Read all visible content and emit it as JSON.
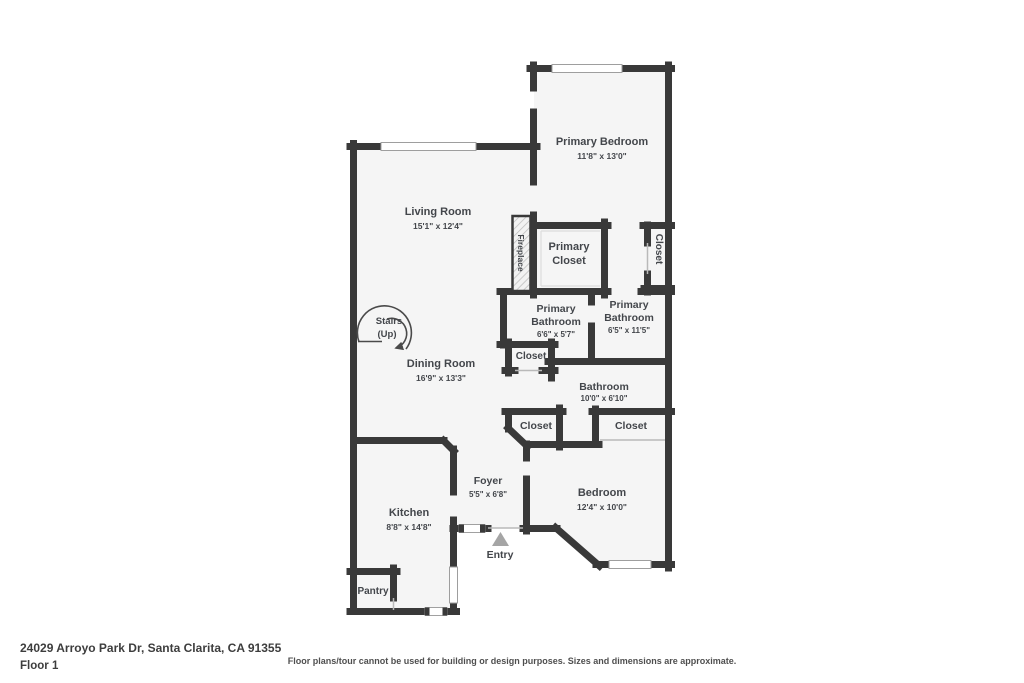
{
  "plan": {
    "rooms": {
      "living_room": {
        "name": "Living Room",
        "dims": "15'1\" x 12'4\""
      },
      "dining_room": {
        "name": "Dining Room",
        "dims": "16'9\" x 13'3\""
      },
      "kitchen": {
        "name": "Kitchen",
        "dims": "8'8\" x 14'8\""
      },
      "foyer": {
        "name": "Foyer",
        "dims": "5'5\" x 6'8\""
      },
      "primary_bedroom": {
        "name": "Primary Bedroom",
        "dims": "11'8\" x 13'0\""
      },
      "primary_closet": {
        "line1": "Primary",
        "line2": "Closet"
      },
      "primary_bathroom_small": {
        "line1": "Primary",
        "line2": "Bathroom",
        "dims": "6'6\" x 5'7\""
      },
      "primary_bathroom_large": {
        "line1": "Primary",
        "line2": "Bathroom",
        "dims": "6'5\" x 11'5\""
      },
      "bathroom": {
        "name": "Bathroom",
        "dims": "10'0\" x 6'10\""
      },
      "bedroom": {
        "name": "Bedroom",
        "dims": "12'4\" x 10'0\""
      },
      "closet_upper_right": {
        "name": "Closet"
      },
      "closet_hall": {
        "name": "Closet"
      },
      "closet_foyer": {
        "name": "Closet"
      },
      "closet_bedroom": {
        "name": "Closet"
      },
      "pantry": {
        "name": "Pantry"
      },
      "fireplace": {
        "name": "Fireplace"
      },
      "stairs": {
        "line1": "Stairs",
        "line2": "(Up)"
      },
      "entry": {
        "name": "Entry"
      }
    },
    "colors": {
      "wall": "#393939",
      "floor": "#f5f5f5",
      "text": "#43464b",
      "entry_arrow": "#a5a5a5"
    }
  },
  "footer": {
    "address": "24029 Arroyo Park Dr, Santa Clarita, CA 91355",
    "floor_label": "Floor 1",
    "disclaimer": "Floor plans/tour cannot be used for building or design purposes. Sizes and dimensions are approximate."
  }
}
